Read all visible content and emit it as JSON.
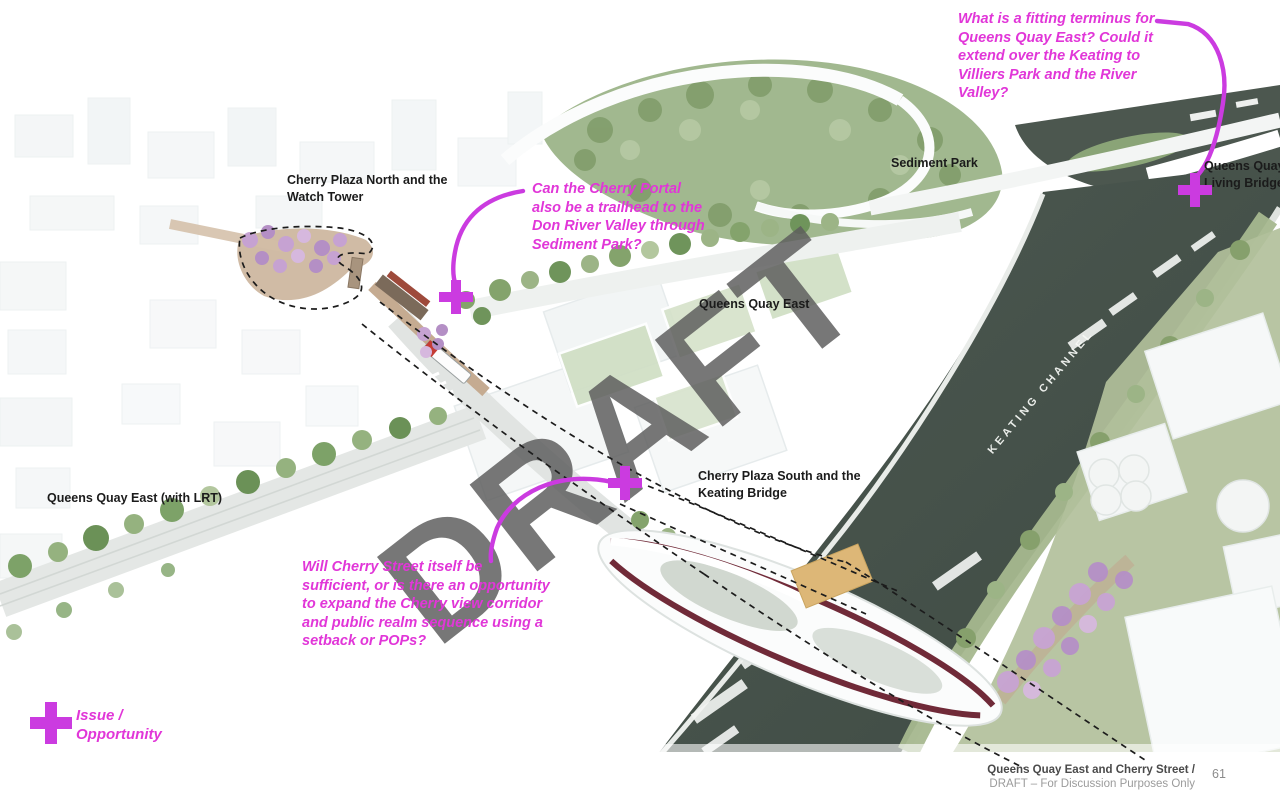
{
  "watermark": {
    "text": "DRAFT"
  },
  "callouts": {
    "terminus": {
      "lines": [
        "What is a fitting terminus for",
        "Queens Quay East? Could it",
        "extend over the Keating to",
        "Villiers Park and the River",
        "Valley?"
      ]
    },
    "portal": {
      "lines": [
        "Can the Cherry Portal",
        "also be a trailhead to the",
        "Don River Valley through",
        "Sediment Park?"
      ]
    },
    "cherry_street": {
      "lines": [
        "Will Cherry Street itself be",
        "sufficient, or is there an opportunity",
        "to expand the Cherry view corridor",
        "and public realm sequence using a",
        "setback or POPs?"
      ]
    }
  },
  "labels": {
    "plaza_north": {
      "lines": [
        "Cherry Plaza North and the",
        "Watch Tower"
      ]
    },
    "sediment_park": {
      "text": "Sediment Park"
    },
    "living_bridge": {
      "lines": [
        "Queens Quay",
        "Living Bridge"
      ]
    },
    "qq_east": {
      "text": "Queens Quay East"
    },
    "plaza_south": {
      "lines": [
        "Cherry Plaza South and the",
        "Keating Bridge"
      ]
    },
    "qq_east_lrt": {
      "text": "Queens Quay East (with LRT)"
    },
    "keating_channel": {
      "text": "KEATING CHANNEL"
    }
  },
  "legend": {
    "lines": [
      "Issue /",
      "Opportunity"
    ]
  },
  "footer": {
    "title": "Queens Quay East and Cherry Street /",
    "subtitle": "DRAFT – For Discussion Purposes Only",
    "page_number": "61"
  },
  "colors": {
    "annotation": "#e136d8",
    "marker": "#cb3be0",
    "label": "#1b1b1b",
    "watermark": "#5e5e5e",
    "water": "#46524b",
    "foliage": "#93ad7f",
    "blossom": "#c7a3d3"
  }
}
